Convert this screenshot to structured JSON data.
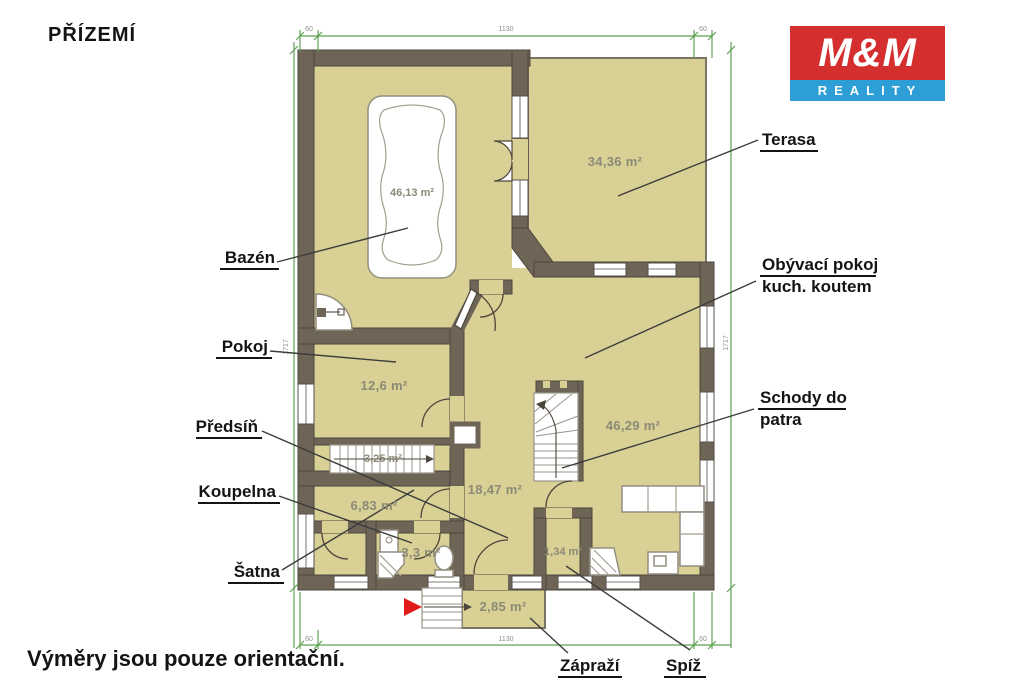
{
  "page": {
    "title": "PŘÍZEMÍ",
    "footnote": "Výměry jsou pouze orientační."
  },
  "logo": {
    "line1": "M&M",
    "line2": "REALITY",
    "red": "#d42f2e",
    "blue": "#2e9ed7"
  },
  "room_labels": {
    "bazen": "Bazén",
    "pokoj": "Pokoj",
    "predsin": "Předsíň",
    "koupelna": "Koupelna",
    "satna": "Šatna",
    "terasa": "Terasa",
    "obyvaci_line1": "Obývací pokoj",
    "obyvaci_line2": "kuch. koutem",
    "schody_line1": "Schody do",
    "schody_line2": "patra",
    "zaprazi": "Zápraží",
    "spiz": "Spíž"
  },
  "areas": {
    "bazen": "46,13 m²",
    "terasa": "34,36 m²",
    "pokoj": "12,6 m²",
    "obyvaci": "46,29 m²",
    "predsin": "18,47 m²",
    "schodiste": "3,25 m²",
    "satna": "6,83 m²",
    "koupelna": "3,3 m²",
    "spiz": "1,34 m²",
    "zaprazi": "2,85 m²"
  },
  "dimensions": {
    "top_left": "60",
    "top_width": "1130",
    "top_right": "60",
    "bottom_left": "60",
    "bottom_width": "1130",
    "bottom_right": "60",
    "left_height": "1717",
    "right_height": "1717"
  },
  "colors": {
    "floor": "#d8d094",
    "wall": "#6e6557",
    "dimension_green": "#5fa053",
    "arrow_red": "#e01b1b"
  }
}
